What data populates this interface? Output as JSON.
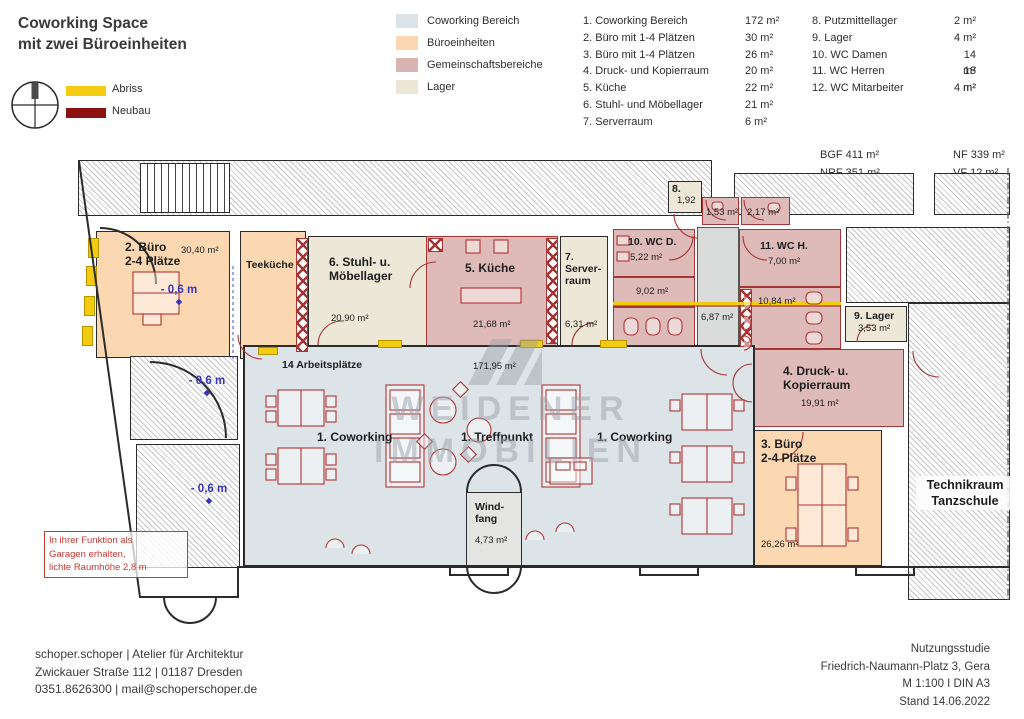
{
  "title": {
    "line1": "Coworking Space",
    "line2": "mit zwei Büroeinheiten"
  },
  "legend": {
    "abriss": {
      "label": "Abriss",
      "color": "#f3cc12"
    },
    "neubau": {
      "label": "Neubau",
      "color": "#8e1111"
    },
    "areas": [
      {
        "label": "Coworking Bereich",
        "color": "#dbe3e6"
      },
      {
        "label": "Büroeinheiten",
        "color": "#fbd8b2"
      },
      {
        "label": "Gemeinschaftsbereiche",
        "color": "#d9b3b1"
      },
      {
        "label": "Lager",
        "color": "#ece6d6"
      }
    ]
  },
  "room_list": {
    "col1": [
      {
        "label": "1. Coworking Bereich",
        "area": "172 m²"
      },
      {
        "label": "2. Büro mit 1-4 Plätzen",
        "area": "30 m²"
      },
      {
        "label": "3. Büro mit 1-4 Plätzen",
        "area": "26 m²"
      },
      {
        "label": "4. Druck- und Kopierraum",
        "area": "20 m²"
      },
      {
        "label": "5. Küche",
        "area": "22 m²"
      },
      {
        "label": "6. Stuhl- und Möbellager",
        "area": "21 m²"
      },
      {
        "label": "7. Serverraum",
        "area": "6 m²"
      }
    ],
    "col2": [
      {
        "label": "8. Putzmittellager",
        "area": "2 m²"
      },
      {
        "label": "9. Lager",
        "area": "4 m²"
      },
      {
        "label": "10. WC Damen",
        "area": "14 m²"
      },
      {
        "label": "11. WC Herren",
        "area": "18 m²"
      },
      {
        "label": "12. WC Mitarbeiter",
        "area": "4 m²"
      }
    ]
  },
  "summary": {
    "bgf": "BGF 411 m²",
    "nrf": "NRF 351 m²",
    "nf": "NF  339 m²",
    "vf": "VF 12 m²"
  },
  "plan": {
    "room2": {
      "line1": "2. Büro",
      "line2": "2-4 Plätze",
      "area": "30,40 m²",
      "level": "- 0,6 m"
    },
    "teekueche": {
      "name": "Teeküche"
    },
    "room6": {
      "line1": "6. Stuhl- u.",
      "line2": "Möbellager",
      "area": "20,90 m²"
    },
    "room5": {
      "name": "5. Küche",
      "area": "21,68 m²"
    },
    "room7": {
      "line1": "7.",
      "line2": "Server-",
      "line3": "raum",
      "area": "6,31 m²"
    },
    "room8": {
      "name": "8.",
      "area": "1,92"
    },
    "small1": {
      "area": "1,53 m²"
    },
    "small2": {
      "area": "2,17 m²"
    },
    "wc_d": {
      "name": "10. WC D.",
      "area": "5,22 m²",
      "sub": "9,02 m²"
    },
    "corridor": {
      "area": "6,87 m²"
    },
    "wc_h": {
      "name": "11. WC H.",
      "area": "7,00 m²",
      "sub": "10,84 m²"
    },
    "room9": {
      "name": "9. Lager",
      "area": "3,53 m²"
    },
    "room4": {
      "line1": "4. Druck- u.",
      "line2": "Kopierraum",
      "area": "19,91 m²"
    },
    "room3": {
      "line1": "3. Büro",
      "line2": "2-4 Plätze",
      "area": "26,26 m²"
    },
    "coworking": {
      "workplaces": "14 Arbeitsplätze",
      "area": "171,95 m²",
      "label1": "1. Coworking",
      "label2": "1. Treffpunkt",
      "label3": "1. Coworking"
    },
    "windfang": {
      "line1": "Wind-",
      "line2": "fang",
      "area": "4,73 m²"
    },
    "garage_top": {
      "level": "- 0,6 m"
    },
    "garage_bottom": {
      "level": "- 0,6 m"
    },
    "technikraum": {
      "line1": "Technikraum",
      "line2": "Tanzschule"
    },
    "note": {
      "line1": "In ihrer Funktion als",
      "line2": "Garagen erhalten,",
      "line3": "lichte Raumhöhe 2,8 m"
    },
    "watermark": {
      "line1": "WEIDENER",
      "line2": "IMMOBILIEN"
    }
  },
  "footer": {
    "left": [
      "schoper.schoper | Atelier für Architektur",
      "Zwickauer Straße 112 | 01187 Dresden",
      "0351.8626300 | mail@schoperschoper.de"
    ],
    "right": [
      "Nutzungsstudie",
      "Friedrich-Naumann-Platz 3, Gera",
      "M 1:100 I DIN A3",
      "Stand 14.06.2022"
    ]
  }
}
